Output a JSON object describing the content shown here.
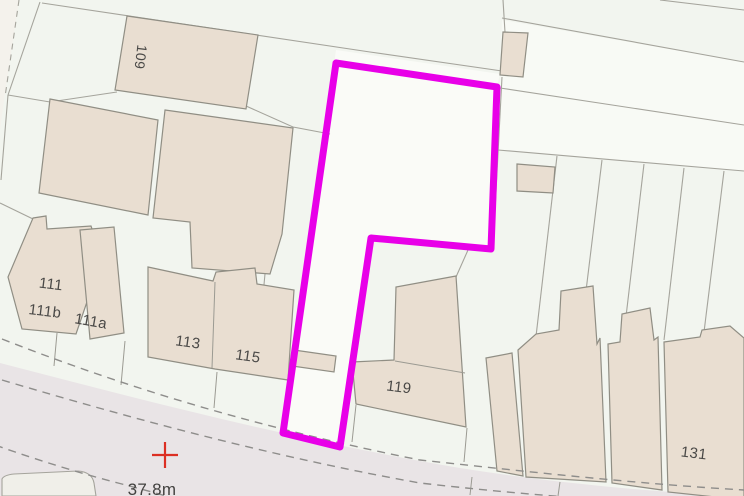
{
  "map": {
    "type": "ordnance-survey-style-site-plan",
    "labels": {
      "b109": "109",
      "b111": "111",
      "b111b": "111b",
      "b111a": "111a",
      "b113": "113",
      "b115": "115",
      "b119": "119",
      "b131": "131"
    },
    "spot_height": "37.8m",
    "colors": {
      "background": "#f3f4ee",
      "parcel_fill": "#f1f5ee",
      "site_fill": "#fafbf7",
      "light_strip_fill": "#f8faf5",
      "building_fill": "#e9ded1",
      "road_fill": "#e9e4e6",
      "island_fill": "#f0efe9",
      "boundary": "#e800e8",
      "marker_red": "#dc2f23",
      "label_text": "#4a4947"
    }
  }
}
